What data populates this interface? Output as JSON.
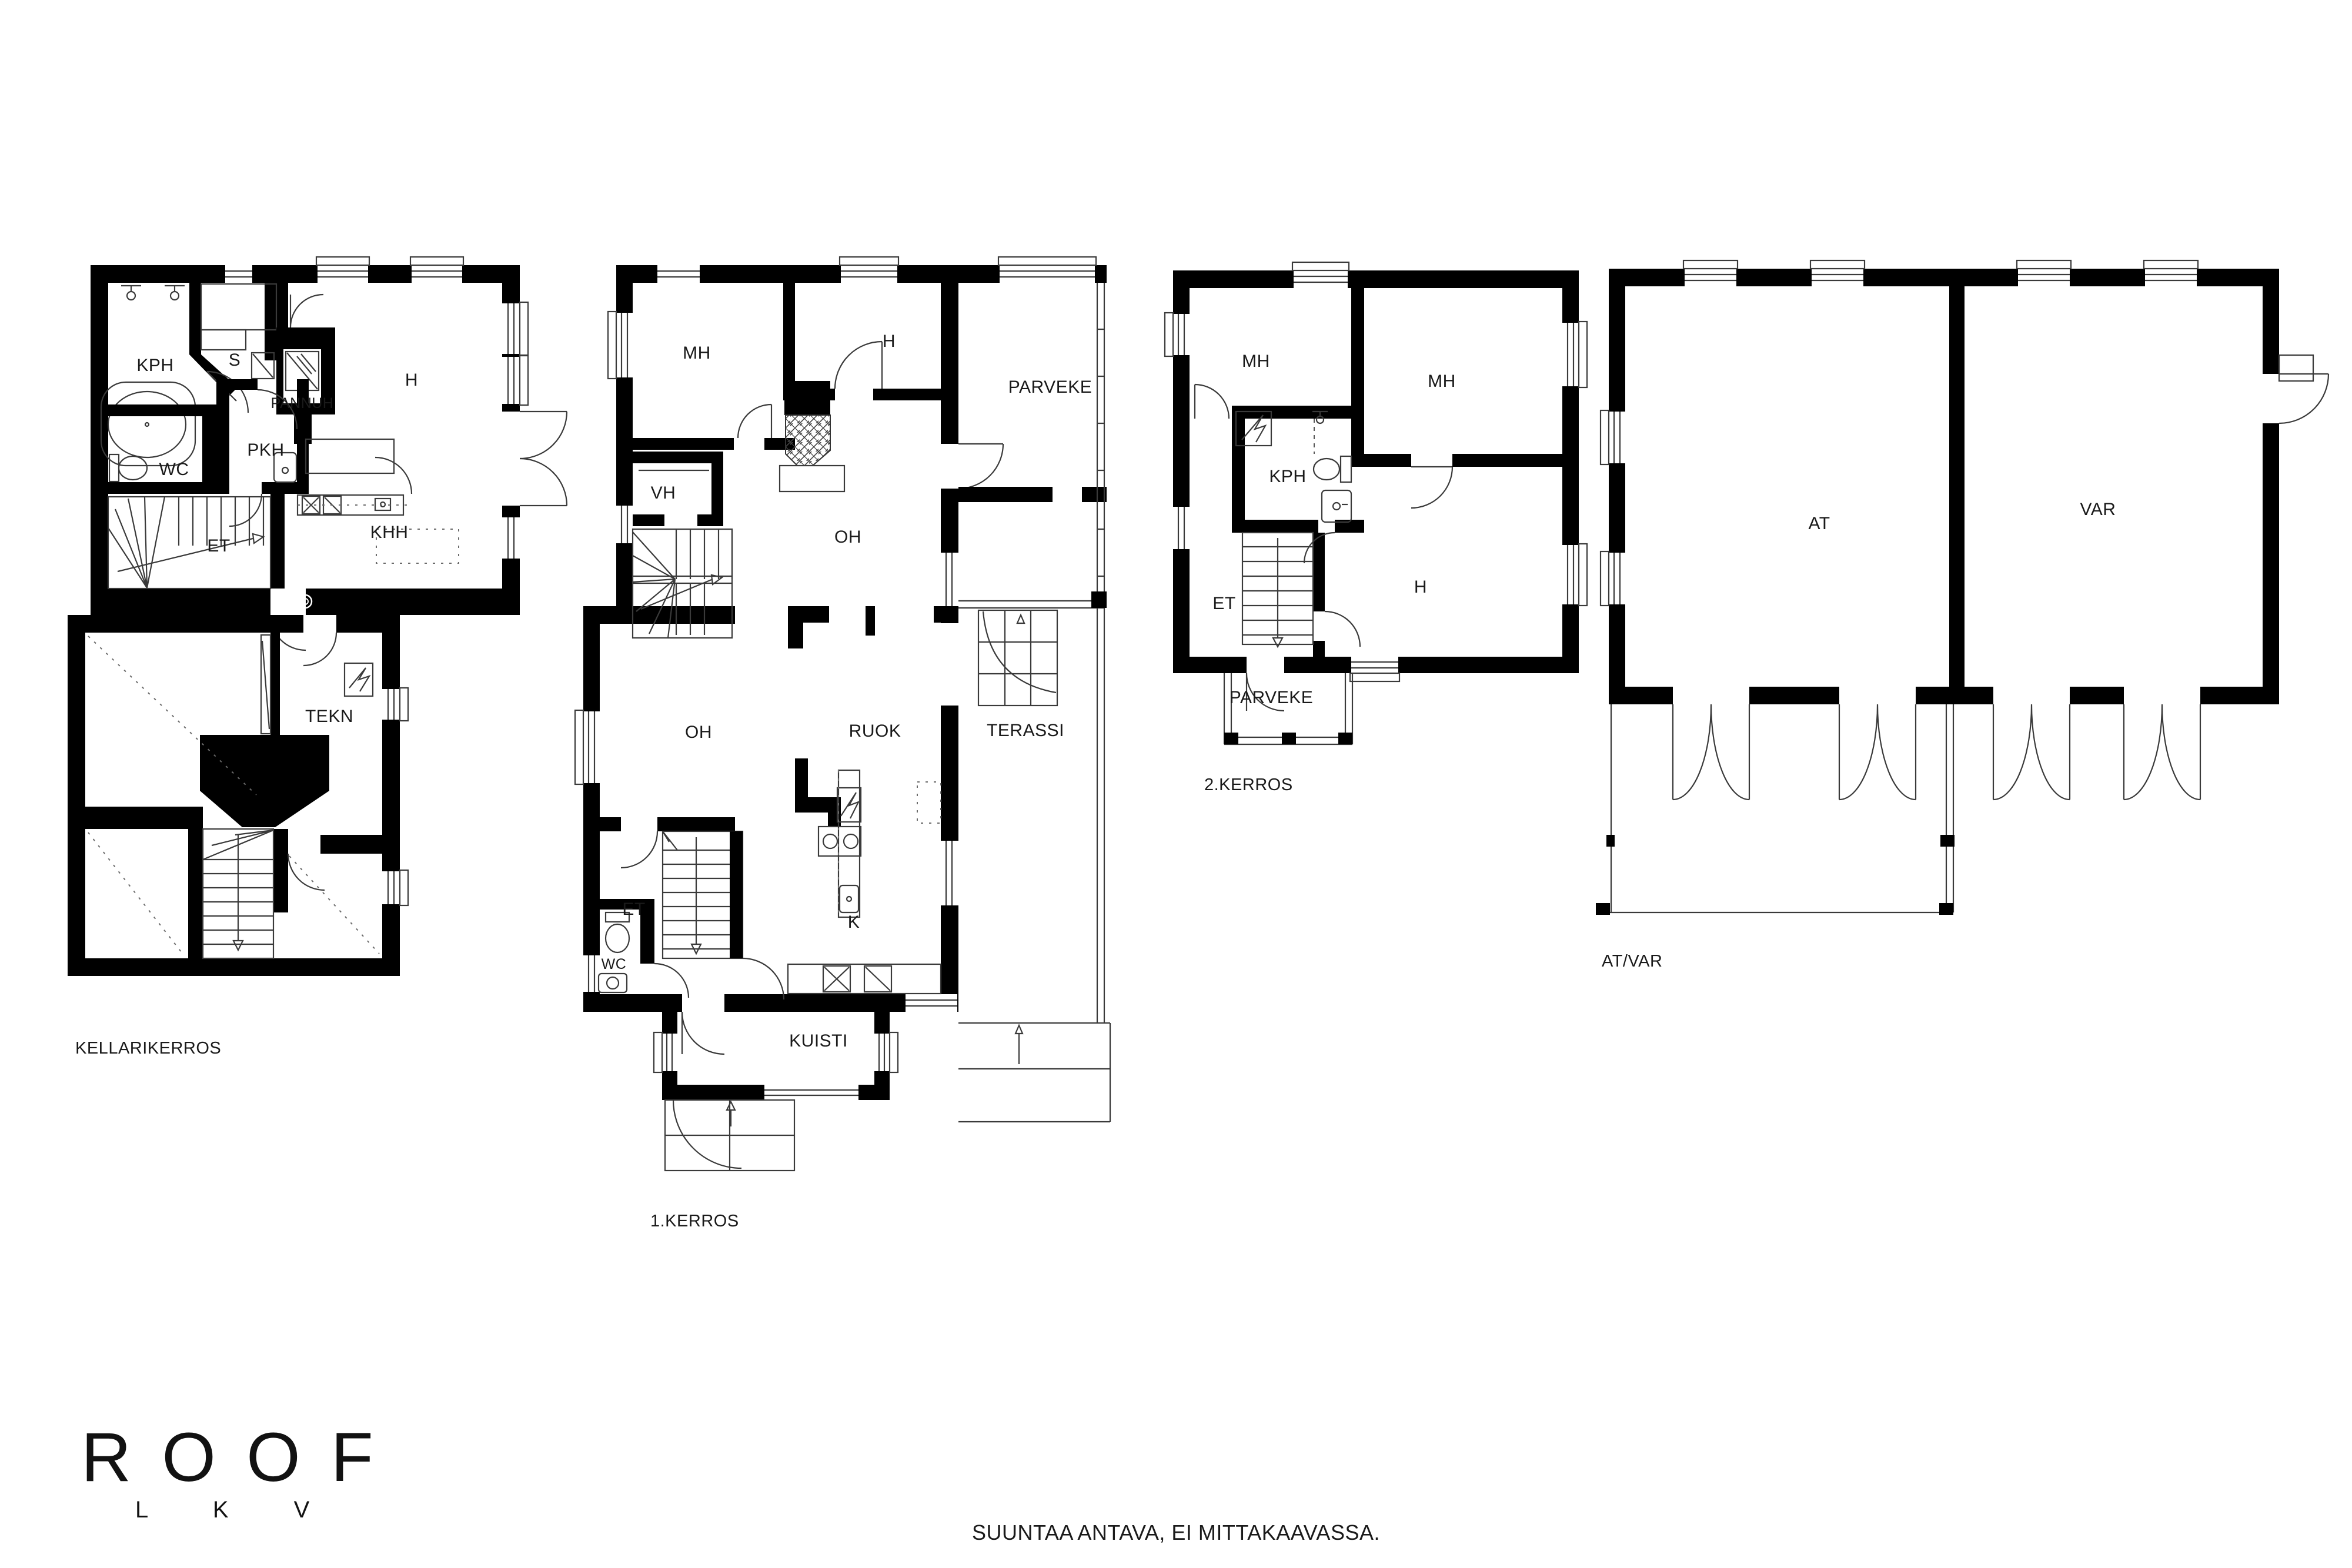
{
  "title": "Floor plan sheet",
  "colors": {
    "wall": "#000000",
    "line": "#3a3a3a",
    "text": "#1a1a1a",
    "background": "#ffffff"
  },
  "logo": {
    "brand": "ROOF",
    "sub": "L K V"
  },
  "footer": {
    "note": "SUUNTAA ANTAVA, EI MITTAKAAVASSA."
  },
  "floors": {
    "basement": {
      "caption": "KELLARIKERROS",
      "rooms": {
        "kph": "KPH",
        "s": "S",
        "pannuh": "PANNUH",
        "h": "H",
        "wc": "WC",
        "pkh": "PKH",
        "et": "ET",
        "khh": "KHH",
        "tekn": "TEKN"
      }
    },
    "floor1": {
      "caption": "1.KERROS",
      "rooms": {
        "mh": "MH",
        "h": "H",
        "vh": "VH",
        "oh_upper": "OH",
        "parveke": "PARVEKE",
        "oh": "OH",
        "ruok": "RUOK",
        "terassi": "TERASSI",
        "et": "ET",
        "k": "K",
        "wc": "WC",
        "kuisti": "KUISTI"
      }
    },
    "floor2": {
      "caption": "2.KERROS",
      "rooms": {
        "mh_left": "MH",
        "mh_right": "MH",
        "kph": "KPH",
        "et": "ET",
        "h": "H",
        "parveke": "PARVEKE"
      }
    },
    "outbuilding": {
      "caption": "AT/VAR",
      "rooms": {
        "at": "AT",
        "var": "VAR"
      }
    }
  }
}
